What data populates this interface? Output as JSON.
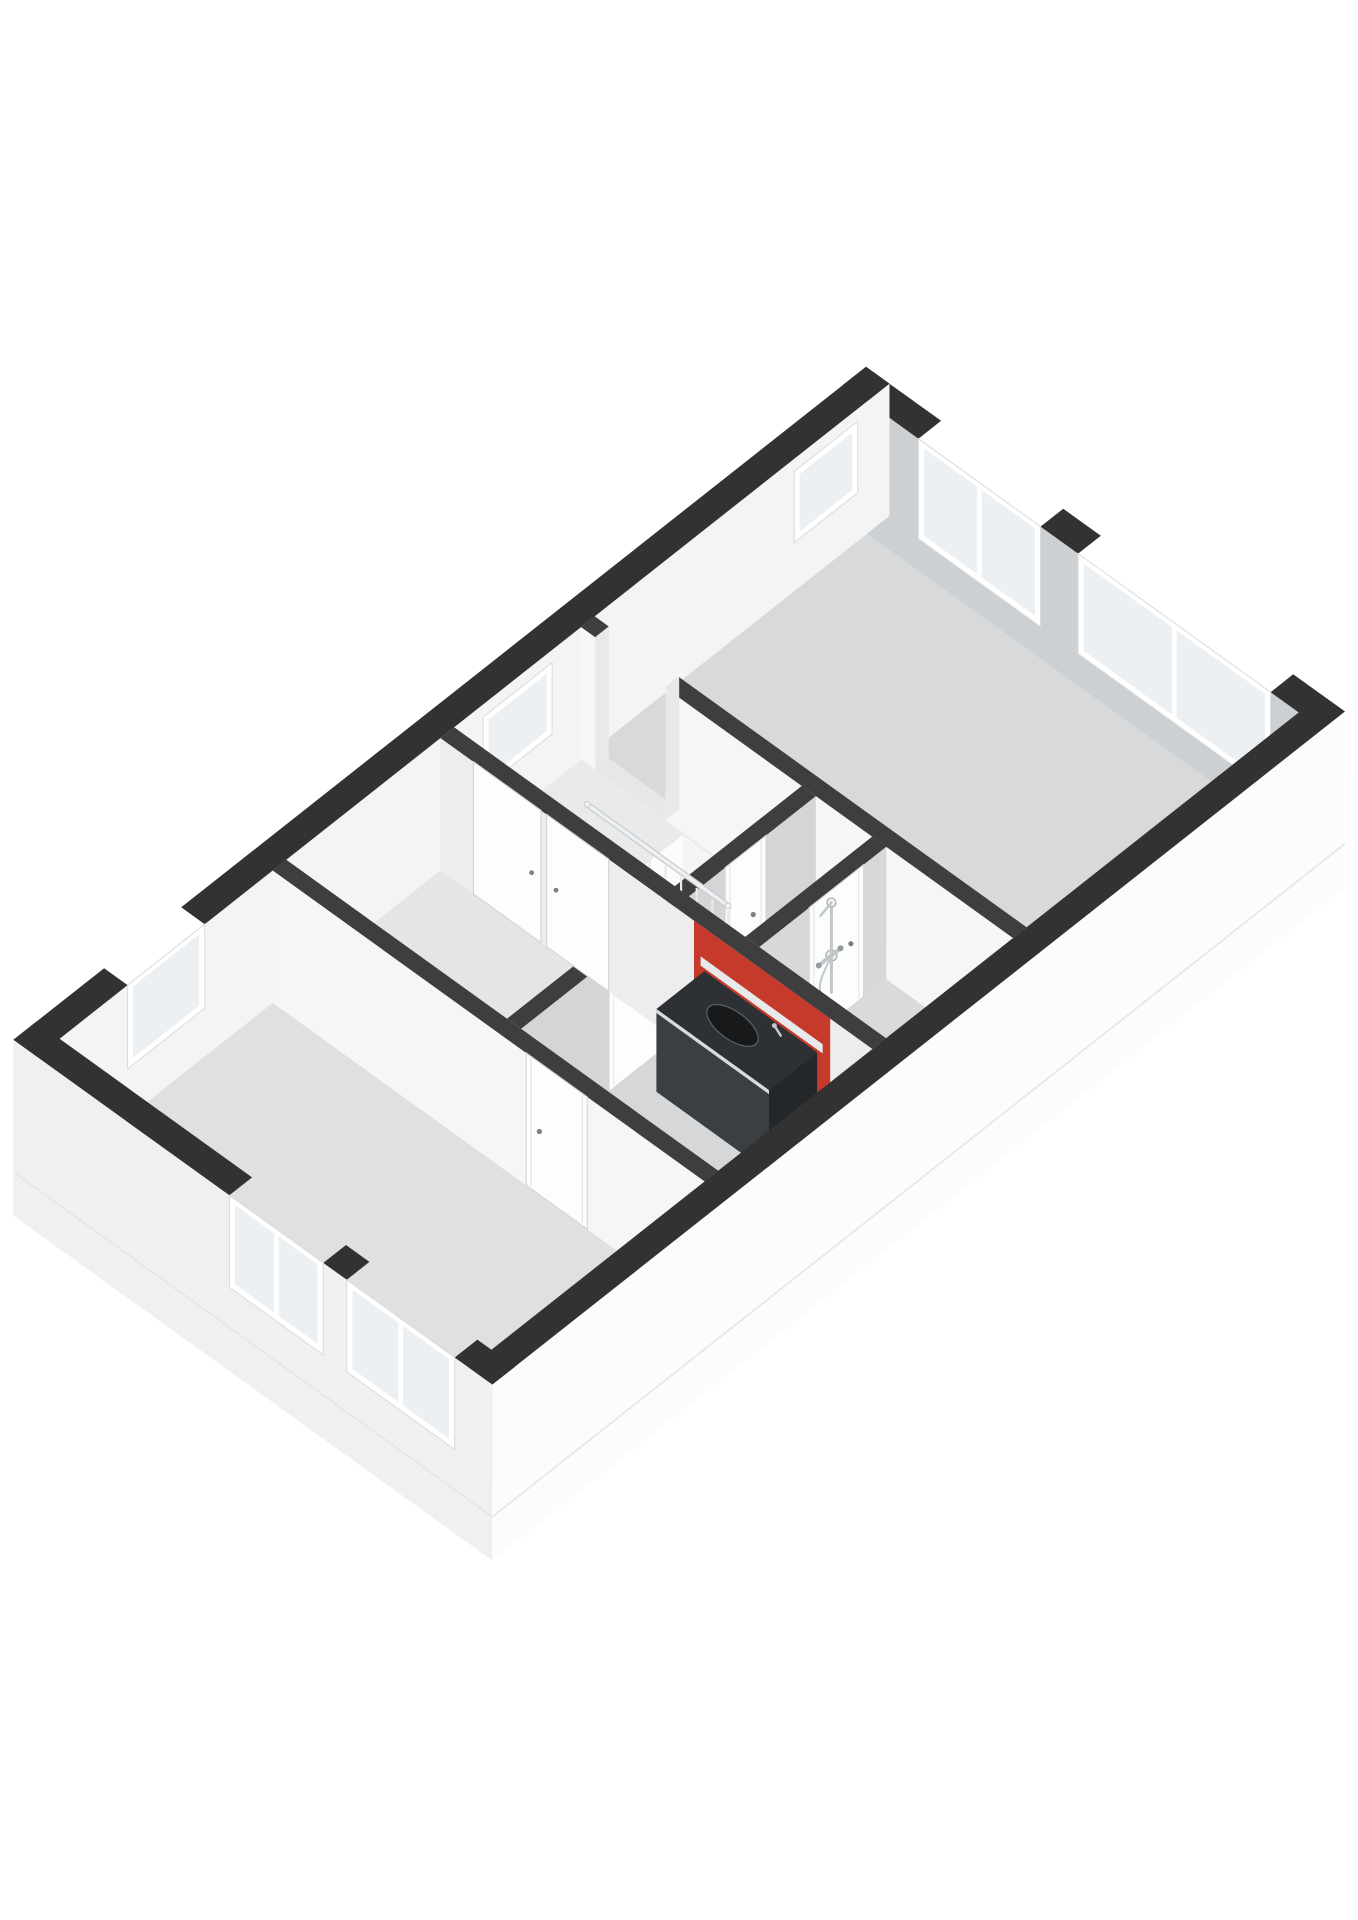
{
  "page": {
    "width": 1358,
    "height": 1920,
    "background": "#ffffff"
  },
  "scene": {
    "type": "floorplan-3d-axonometric",
    "floor_label": "upper-floor",
    "projection": {
      "origin": [
        866,
        499
      ],
      "ex": [
        93.9,
        67.6
      ],
      "ey": [
        -90.7,
        71.6
      ],
      "ez": 115,
      "cut_height": 1.15,
      "skirt_depth": 0.38
    },
    "building": {
      "width_m": 5.1,
      "length_m": 9.4,
      "ext_wall_t": 0.25,
      "int_wall_t": 0.15
    }
  },
  "palette": {
    "background": "#ffffff",
    "band_ext": "#323232",
    "band_int": "#3e3e3e",
    "jamb": "#e8e9ea",
    "threshold": "#e6e7e8",
    "frame": "#ffffff",
    "frame_edge": "#d9dbdc",
    "glass": "#edf0f2",
    "door": "#fcfdfd",
    "door_edge": "#d4d6d8",
    "door_seam": "#e8eaeb",
    "handle": "#7c8084",
    "void_floor": "#ffffff",
    "void_face_a": "#fcfcfd",
    "void_face_b": "#f4f5f6",
    "step_top": "#fafbfb",
    "step_alt": "#ffffff",
    "riser": "#e6e7e9",
    "rail": "#eef0f1",
    "rail_shadow": "#c9cccf",
    "baluster": "#e7e9eb",
    "radiator_bar": "#dfe2e4",
    "radiator_edge": "#b9bcbf",
    "radiator_header": "#c6c9cb",
    "knob": "#75797d",
    "chrome": "#c3c6c9",
    "chrome_dark": "#989ca0",
    "vanity_top": "#2d3135",
    "vanity_front": "#3a3f44",
    "vanity_side": "#24272a",
    "vanity_rim": "#dadbdc",
    "sink": "#17191b",
    "ledge": "#e8e9ea",
    "accent_red": "#c63a2c",
    "slab_line": "#e4e5e7"
  },
  "floors": [
    {
      "name": "floor-bedroom-1",
      "rect": [
        0.25,
        0.25,
        4.85,
        3.25
      ],
      "color": "#d8d9db"
    },
    {
      "name": "floor-landing",
      "rect": [
        0.25,
        3.4,
        3.35,
        4.8
      ],
      "color": "#e9eaeb"
    },
    {
      "name": "floor-shower-room",
      "rect": [
        3.5,
        3.4,
        4.85,
        4.8
      ],
      "color": "#d9dadc"
    },
    {
      "name": "floor-bedroom-2",
      "rect": [
        0.25,
        4.95,
        2.6,
        6.65
      ],
      "color": "#e4e5e7"
    },
    {
      "name": "floor-bathroom",
      "rect": [
        2.75,
        4.95,
        4.85,
        6.65
      ],
      "color": "#d6d7d9"
    },
    {
      "name": "floor-bedroom-3",
      "rect": [
        0.25,
        6.8,
        4.85,
        9.15
      ],
      "color": "#dfe0e2"
    }
  ],
  "stairwell": {
    "name": "stairwell-void",
    "void": [
      1.35,
      3.42,
      2.58,
      4.38
    ],
    "depth": 1.1,
    "steps": {
      "count": 6,
      "start_a": 2.54,
      "tread": 0.22,
      "drop": 0.16,
      "b0": 3.46,
      "b1": 4.34
    }
  },
  "walls_back": [
    {
      "name": "facade-ne",
      "axis": "a",
      "pos": 0,
      "t": 0.25,
      "from": 0,
      "to": 5.1,
      "band": "ext",
      "face": "#cdd0d2",
      "windows": [
        {
          "from": 0.8,
          "to": 2.1,
          "sill": 0.28,
          "through": true
        },
        {
          "from": 2.5,
          "to": 4.55,
          "sill": 0.28,
          "through": true
        }
      ]
    },
    {
      "name": "facade-nw",
      "axis": "b",
      "pos": 0,
      "t": 0.25,
      "from": 0,
      "to": 9.4,
      "band": "ext",
      "face": "#f4f4f5",
      "windows": [
        {
          "from": 0.35,
          "to": 1.05,
          "sill": 0.42,
          "top": 1.04
        },
        {
          "from": 3.72,
          "to": 4.48,
          "sill": 0.42,
          "top": 1.04
        },
        {
          "from": 7.55,
          "to": 8.4,
          "sill": 0.42,
          "through": true
        }
      ]
    },
    {
      "name": "wall-bedroom-1",
      "axis": "a",
      "pos": 3.25,
      "t": 0.15,
      "from": 0.25,
      "to": 4.85,
      "band": "int",
      "face": "#f6f6f7",
      "gaps": [
        [
          0.4,
          1.15
        ]
      ]
    },
    {
      "name": "wall-landing",
      "axis": "b",
      "pos": 2.6,
      "t": 0.15,
      "from": 3.4,
      "to": 6.65,
      "band": "int",
      "face": "#d3d5d7",
      "doors": [
        {
          "from": 3.95,
          "to": 4.4
        },
        {
          "from": 5.05,
          "to": 5.68
        }
      ]
    },
    {
      "name": "wall-shower-room",
      "axis": "b",
      "pos": 3.35,
      "t": 0.15,
      "from": 3.4,
      "to": 4.8,
      "band": "int",
      "face": "#d6d8da",
      "doors": [
        {
          "from": 3.65,
          "to": 4.25
        }
      ]
    }
  ],
  "walls_mid": [
    {
      "name": "wall-bathroom",
      "axis": "a",
      "pos": 4.8,
      "t": 0.15,
      "from": 0.25,
      "to": 4.85,
      "band": "int",
      "face": "#ededee",
      "accent": {
        "from": 2.95,
        "to": 4.4,
        "color": "#c63a2c"
      },
      "closet": {
        "leaves": [
          [
            0.6,
            1.32
          ],
          [
            1.38,
            2.04
          ]
        ]
      }
    }
  ],
  "walls_front": [
    {
      "name": "wall-bedroom-3",
      "axis": "a",
      "pos": 6.65,
      "t": 0.15,
      "from": 0.25,
      "to": 4.85,
      "band": "int",
      "face": "#f5f6f7",
      "doors": [
        {
          "from": 2.95,
          "to": 3.6
        }
      ]
    },
    {
      "name": "facade-se",
      "axis": "b",
      "pos": 4.85,
      "t": 0.25,
      "from": 0,
      "to": 9.4,
      "band": "ext",
      "exterior": true,
      "face": "#fbfcfd"
    },
    {
      "name": "facade-sw",
      "axis": "a",
      "pos": 9.15,
      "t": 0.25,
      "from": 0,
      "to": 5.1,
      "band": "ext",
      "exterior": true,
      "face": "#eff0f2",
      "windows": [
        {
          "from": 2.3,
          "to": 3.3,
          "sill": 0.35,
          "through": true
        },
        {
          "from": 3.55,
          "to": 4.7,
          "sill": 0.35,
          "through": true
        }
      ]
    }
  ],
  "railing": {
    "name": "stair-railing",
    "a0": 1.3,
    "a1": 2.8,
    "b": 4.42,
    "z_top": 0.86,
    "balusters": 10
  },
  "radiator": {
    "name": "radiator",
    "a0": 1.44,
    "b": 4.54,
    "bars": 7,
    "bar_step": 0.115,
    "z0": 0.14,
    "z1": 0.72
  },
  "shower": {
    "name": "shower-fixture",
    "wall_a": 3.515,
    "rail_b": 4.02,
    "rail_z0": 0.28,
    "rail_z1": 1.06,
    "mixer_b0": 3.92,
    "mixer_b1": 4.16,
    "mixer_z": 0.6,
    "hose_b": 4.1,
    "hose_z": 0.3
  },
  "vanity": {
    "name": "bathroom-vanity",
    "a0": 3.08,
    "a1": 4.28,
    "b0": 4.97,
    "b1": 5.5,
    "z_top": 0.8,
    "z_bot": 0.08,
    "ledge": [
      3.02,
      4.32,
      0.8,
      0.88
    ],
    "sink": {
      "a": 3.62,
      "b": 5.22,
      "rx": 30,
      "ry": 14
    },
    "faucet": {
      "a": 3.96,
      "b": 5.04
    }
  }
}
